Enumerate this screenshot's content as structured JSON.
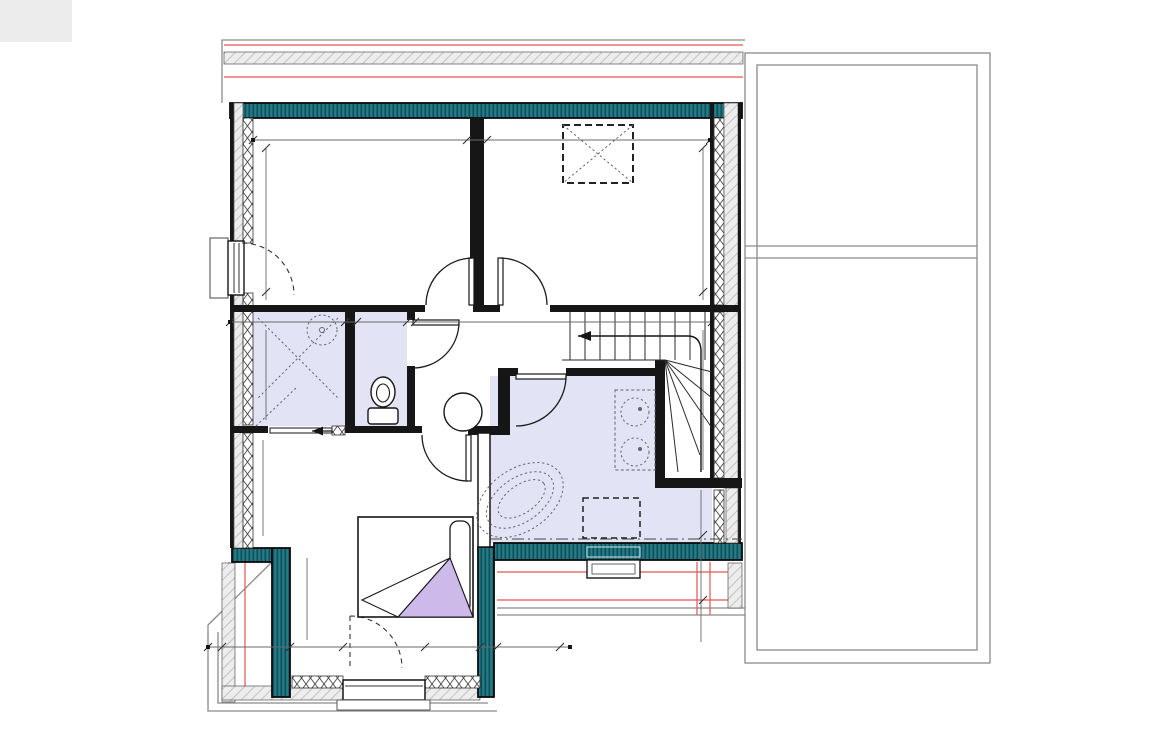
{
  "plan": {
    "rooms": [
      {
        "name": "Chambre 2",
        "size": 17,
        "lines": [
          "SH : 11.38 m²"
        ],
        "x": 358,
        "y": 210
      },
      {
        "name": "Chambre 3",
        "size": 17,
        "lines": [
          "SH : 11.38 m²"
        ],
        "x": 601,
        "y": 210
      },
      {
        "name": "WC",
        "size": 14,
        "lines": [
          "CARRELAGE",
          "SH : 1.73 m²"
        ],
        "x": 382,
        "y": 337
      },
      {
        "name": "Douche",
        "size": 16,
        "lines": [
          "CARRELAGE",
          "SH : 3.32 m²"
        ],
        "x": 296,
        "y": 378
      },
      {
        "name": "Palier",
        "size": 15,
        "lines": [
          "SH : 3.76 m²"
        ],
        "x": 464,
        "y": 368
      },
      {
        "name": "Bains",
        "size": 16,
        "lines": [
          "CARRELAGE",
          "SH : 8.00 m²",
          "SU : 8.30 m²"
        ],
        "x": 572,
        "y": 439
      },
      {
        "name": "Chambre 1",
        "size": 16,
        "lines": [
          "SH : 13.12 m²",
          "SU : 13.20 m²"
        ],
        "x": 368,
        "y": 482
      }
    ],
    "annotations": {
      "velux": "VELUX",
      "velux_size": "1.14x1.18",
      "vr_elec": "VR Elec",
      "alt_left": "Alt : 0.00 m",
      "pp_8": "PP 8",
      "vvr_elec": "VVR Elec",
      "alt_bottom": "Alt : 0.00 m",
      "level_symbol": "+",
      "level_value": "2.98"
    },
    "stair_treads": [
      {
        "t": "16",
        "x": 585
      },
      {
        "t": "15",
        "x": 600
      },
      {
        "t": "14",
        "x": 616
      },
      {
        "t": "13",
        "x": 631
      },
      {
        "t": "12",
        "x": 647
      },
      {
        "t": "11",
        "x": 662
      },
      {
        "t": "10",
        "x": 695
      }
    ],
    "dimension_labels": [
      {
        "t": "22",
        "x": 266,
        "y": 57,
        "r": -90
      },
      {
        "t": "60",
        "x": 266,
        "y": 86,
        "r": -90
      },
      {
        "t": "30",
        "x": 266,
        "y": 112,
        "r": -90
      },
      {
        "t": "22",
        "x": 705,
        "y": 50,
        "r": -90
      },
      {
        "t": "60",
        "x": 705,
        "y": 86,
        "r": -90
      },
      {
        "t": "30",
        "x": 705,
        "y": 112,
        "r": -90
      },
      {
        "t": "34",
        "x": 249,
        "y": 142,
        "r": -90
      },
      {
        "t": "3.82",
        "x": 358,
        "y": 136
      },
      {
        "t": "7",
        "x": 484,
        "y": 136
      },
      {
        "t": "3.82",
        "x": 600,
        "y": 142
      },
      {
        "t": "34",
        "x": 710,
        "y": 139,
        "r": -90
      },
      {
        "t": "2.98",
        "x": 268,
        "y": 213,
        "r": -90
      },
      {
        "t": "2.98",
        "x": 704,
        "y": 213,
        "r": -90
      },
      {
        "t": "34",
        "x": 247,
        "y": 319
      },
      {
        "t": "1.73",
        "x": 300,
        "y": 317
      },
      {
        "t": "7",
        "x": 356,
        "y": 317
      },
      {
        "t": "90",
        "x": 384,
        "y": 316
      },
      {
        "t": "7",
        "x": 414,
        "y": 317
      },
      {
        "t": "4.94",
        "x": 570,
        "y": 319
      },
      {
        "t": "7",
        "x": 701,
        "y": 304,
        "r": -90
      },
      {
        "t": "34",
        "x": 716,
        "y": 319
      },
      {
        "t": "1.92",
        "x": 268,
        "y": 369,
        "r": -90
      },
      {
        "t": "10",
        "x": 268,
        "y": 424,
        "r": -90
      },
      {
        "t": "2.82",
        "x": 705,
        "y": 401,
        "r": -90
      },
      {
        "t": "1.69",
        "x": 265,
        "y": 486,
        "r": -90
      },
      {
        "t": "30",
        "x": 265,
        "y": 541,
        "r": -90
      },
      {
        "t": "7",
        "x": 700,
        "y": 480,
        "r": -90
      },
      {
        "t": "82",
        "x": 702,
        "y": 516,
        "r": -90
      },
      {
        "t": "34",
        "x": 716,
        "y": 523
      },
      {
        "t": "10",
        "x": 703,
        "y": 544,
        "r": -90
      },
      {
        "t": "30",
        "x": 703,
        "y": 558,
        "r": -90
      },
      {
        "t": "60",
        "x": 701,
        "y": 586,
        "r": -90
      },
      {
        "t": "22",
        "x": 703,
        "y": 623,
        "r": -90
      },
      {
        "t": "7",
        "x": 475,
        "y": 525,
        "r": -90
      },
      {
        "t": "10",
        "x": 311,
        "y": 542,
        "r": -90
      },
      {
        "t": "2.13",
        "x": 309,
        "y": 610,
        "r": -90
      },
      {
        "t": "34",
        "x": 308,
        "y": 673,
        "r": -90
      },
      {
        "t": "22",
        "x": 213,
        "y": 648
      },
      {
        "t": "60",
        "x": 253,
        "y": 648
      },
      {
        "t": "30",
        "x": 297,
        "y": 646
      },
      {
        "t": "3.01",
        "x": 383,
        "y": 643
      },
      {
        "t": "30",
        "x": 470,
        "y": 644
      },
      {
        "t": "60",
        "x": 516,
        "y": 644
      },
      {
        "t": "22",
        "x": 553,
        "y": 645
      },
      {
        "t": "3.85",
        "x": 601,
        "y": 522
      }
    ],
    "colors": {
      "teal_wall": "#1d6e7a",
      "teal_stripe": "#0b4e57",
      "wet_room_fill": "#e2e3f4",
      "overhang_red": "#e25555",
      "wall_black": "#161616",
      "hatch_bg": "#ededed",
      "hatch_line": "#bdbdbd",
      "blanket_lavender": "#cdb9ea",
      "outline_gray": "#8a8a8a"
    }
  }
}
